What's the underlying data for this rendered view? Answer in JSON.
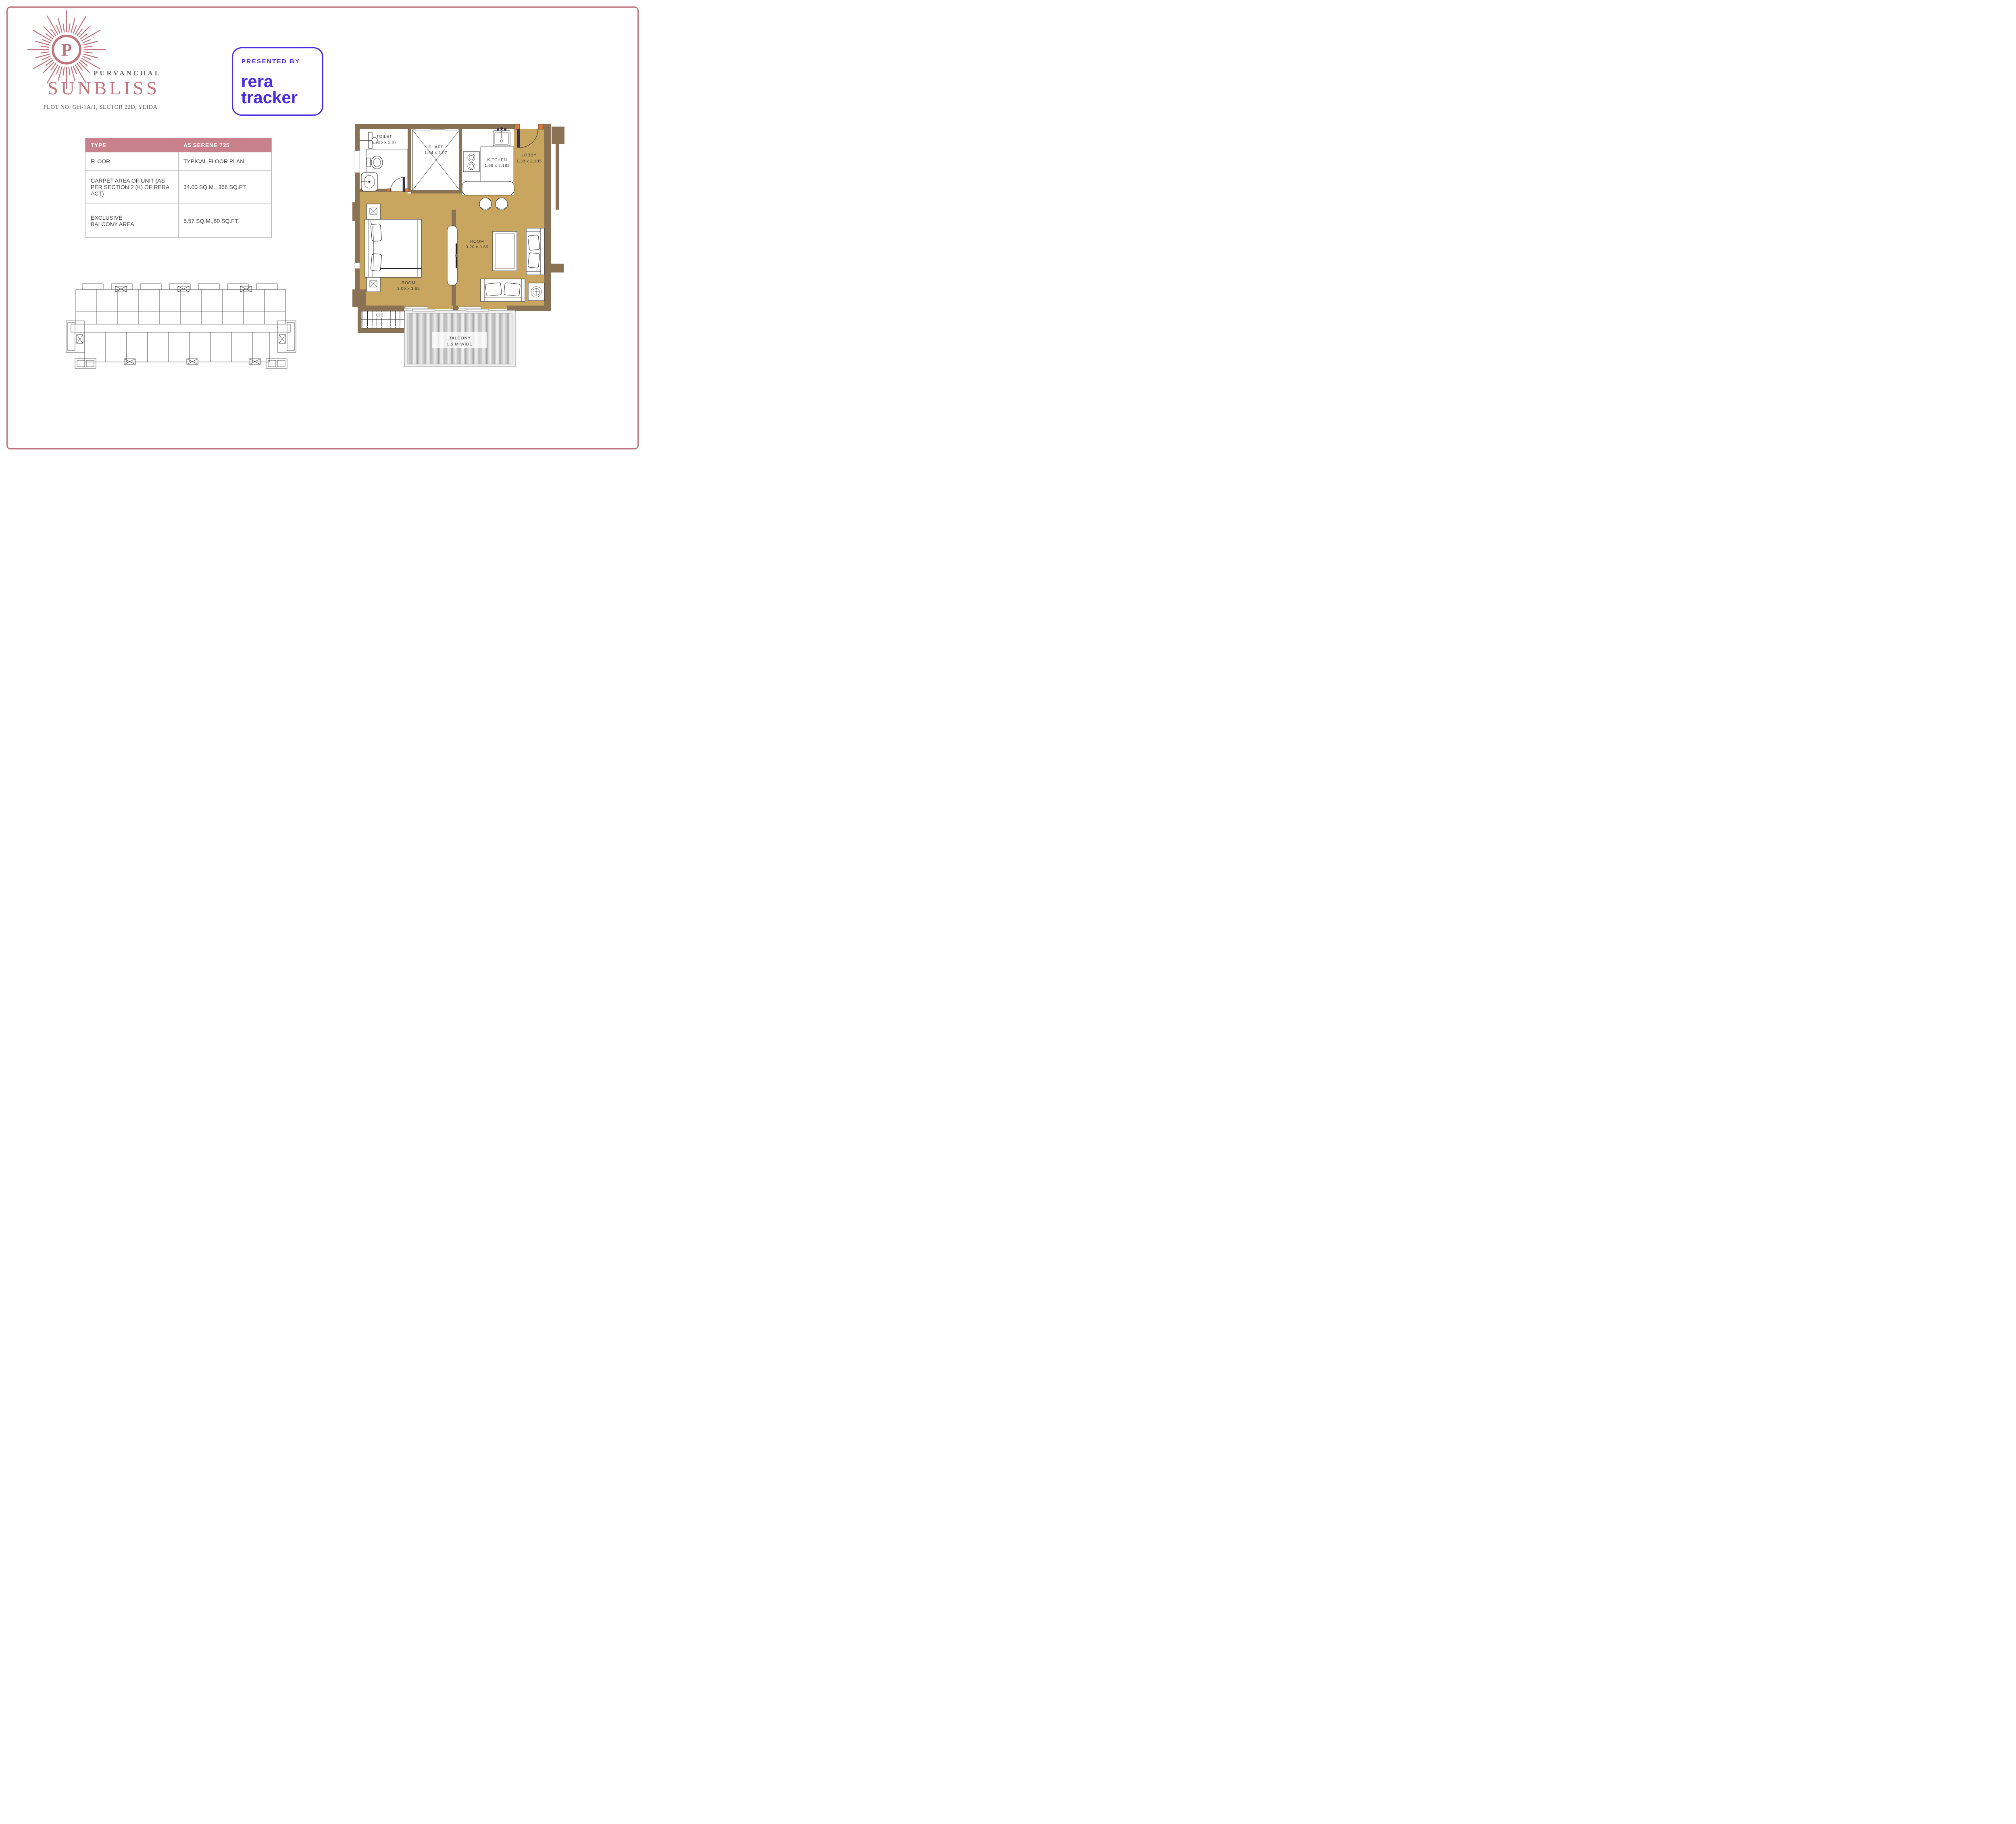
{
  "logo": {
    "monogram": "P",
    "brand": "PURVANCHAL",
    "project": "SUNBLISS",
    "address": "PLOT NO. GH-1A/1, SECTOR 22D, YEIDA"
  },
  "badge": {
    "eyebrow": "PRESENTED BY",
    "line1": "rera",
    "line2": "tracker"
  },
  "spec_table": {
    "headers": [
      "TYPE",
      "A5 SERENE 725"
    ],
    "rows": [
      {
        "label": "FLOOR",
        "value": "TYPICAL FLOOR PLAN"
      },
      {
        "label": "CARPET AREA OF UNIT (AS PER SECTION 2 (K) OF RERA ACT)",
        "value": "34.00 SQ.M., 366 SQ.FT."
      },
      {
        "label": "EXCLUSIVE BALCONY AREA",
        "value": "5.57 SQ.M.,60 SQ.FT."
      }
    ]
  },
  "floor_plan": {
    "rooms": {
      "toilet": {
        "name": "TOILET",
        "dims": "1.525 x 2.07"
      },
      "shaft": {
        "name": "SHAFT",
        "dims": "1.54 x 2.07"
      },
      "kitchen": {
        "name": "KITCHEN",
        "dims": "1.69 x 2.185"
      },
      "lobby": {
        "name": "LOBBY",
        "dims": "1.38 x 2.185"
      },
      "bedroom": {
        "name": "ROOM",
        "dims": "3.05 x 3.65"
      },
      "living": {
        "name": "ROOM",
        "dims": "3.20 x 3.65"
      },
      "balcony": {
        "name": "BALCONY",
        "dims": "1.5 M WIDE"
      },
      "cupboard": {
        "name": "C|B"
      }
    }
  },
  "colors": {
    "accent_rose": "#c0767e",
    "table_header": "#c8828b",
    "page_border": "#bd737f",
    "badge_blue": "#4a2de0",
    "wall_brown": "#8a7355",
    "floor_tan": "#c9a660",
    "door_navy": "#38305a",
    "jamb_orange": "#d8793c"
  }
}
